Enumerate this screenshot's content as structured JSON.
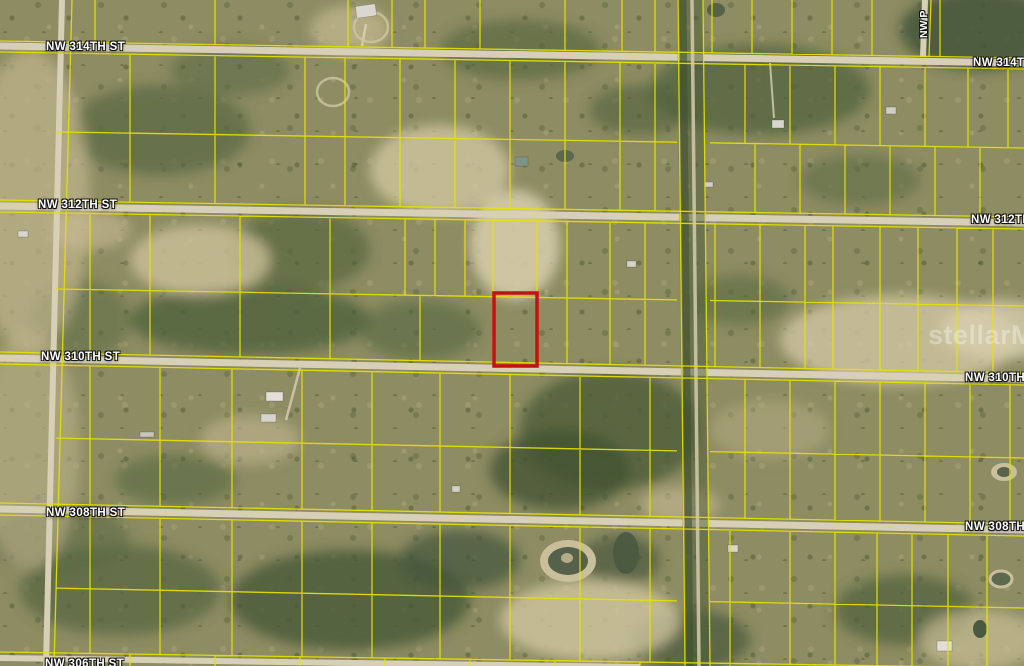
{
  "map": {
    "street_labels": [
      {
        "id": "nw-314th-left",
        "text": "NW 314TH ST"
      },
      {
        "id": "nw-314th-right",
        "text": "NW 314TH ST"
      },
      {
        "id": "nw-312th-left",
        "text": "NW 312TH ST"
      },
      {
        "id": "nw-312th-right",
        "text": "NW 312TH ST"
      },
      {
        "id": "nw-310th-left",
        "text": "NW 310TH ST"
      },
      {
        "id": "nw-310th-right",
        "text": "NW 310TH ST"
      },
      {
        "id": "nw-308th-left",
        "text": "NW 308TH ST"
      },
      {
        "id": "nw-308th-right",
        "text": "NW 308TH ST"
      },
      {
        "id": "nw-306th-bottom",
        "text": "NW 306TH ST"
      },
      {
        "id": "nw-p-vertical",
        "text": "NW P"
      }
    ],
    "watermark": "stellarMLS",
    "colors": {
      "parcel_line": "#e6e200",
      "subject_outline": "#c61111",
      "road": "#d8d0b6"
    }
  }
}
